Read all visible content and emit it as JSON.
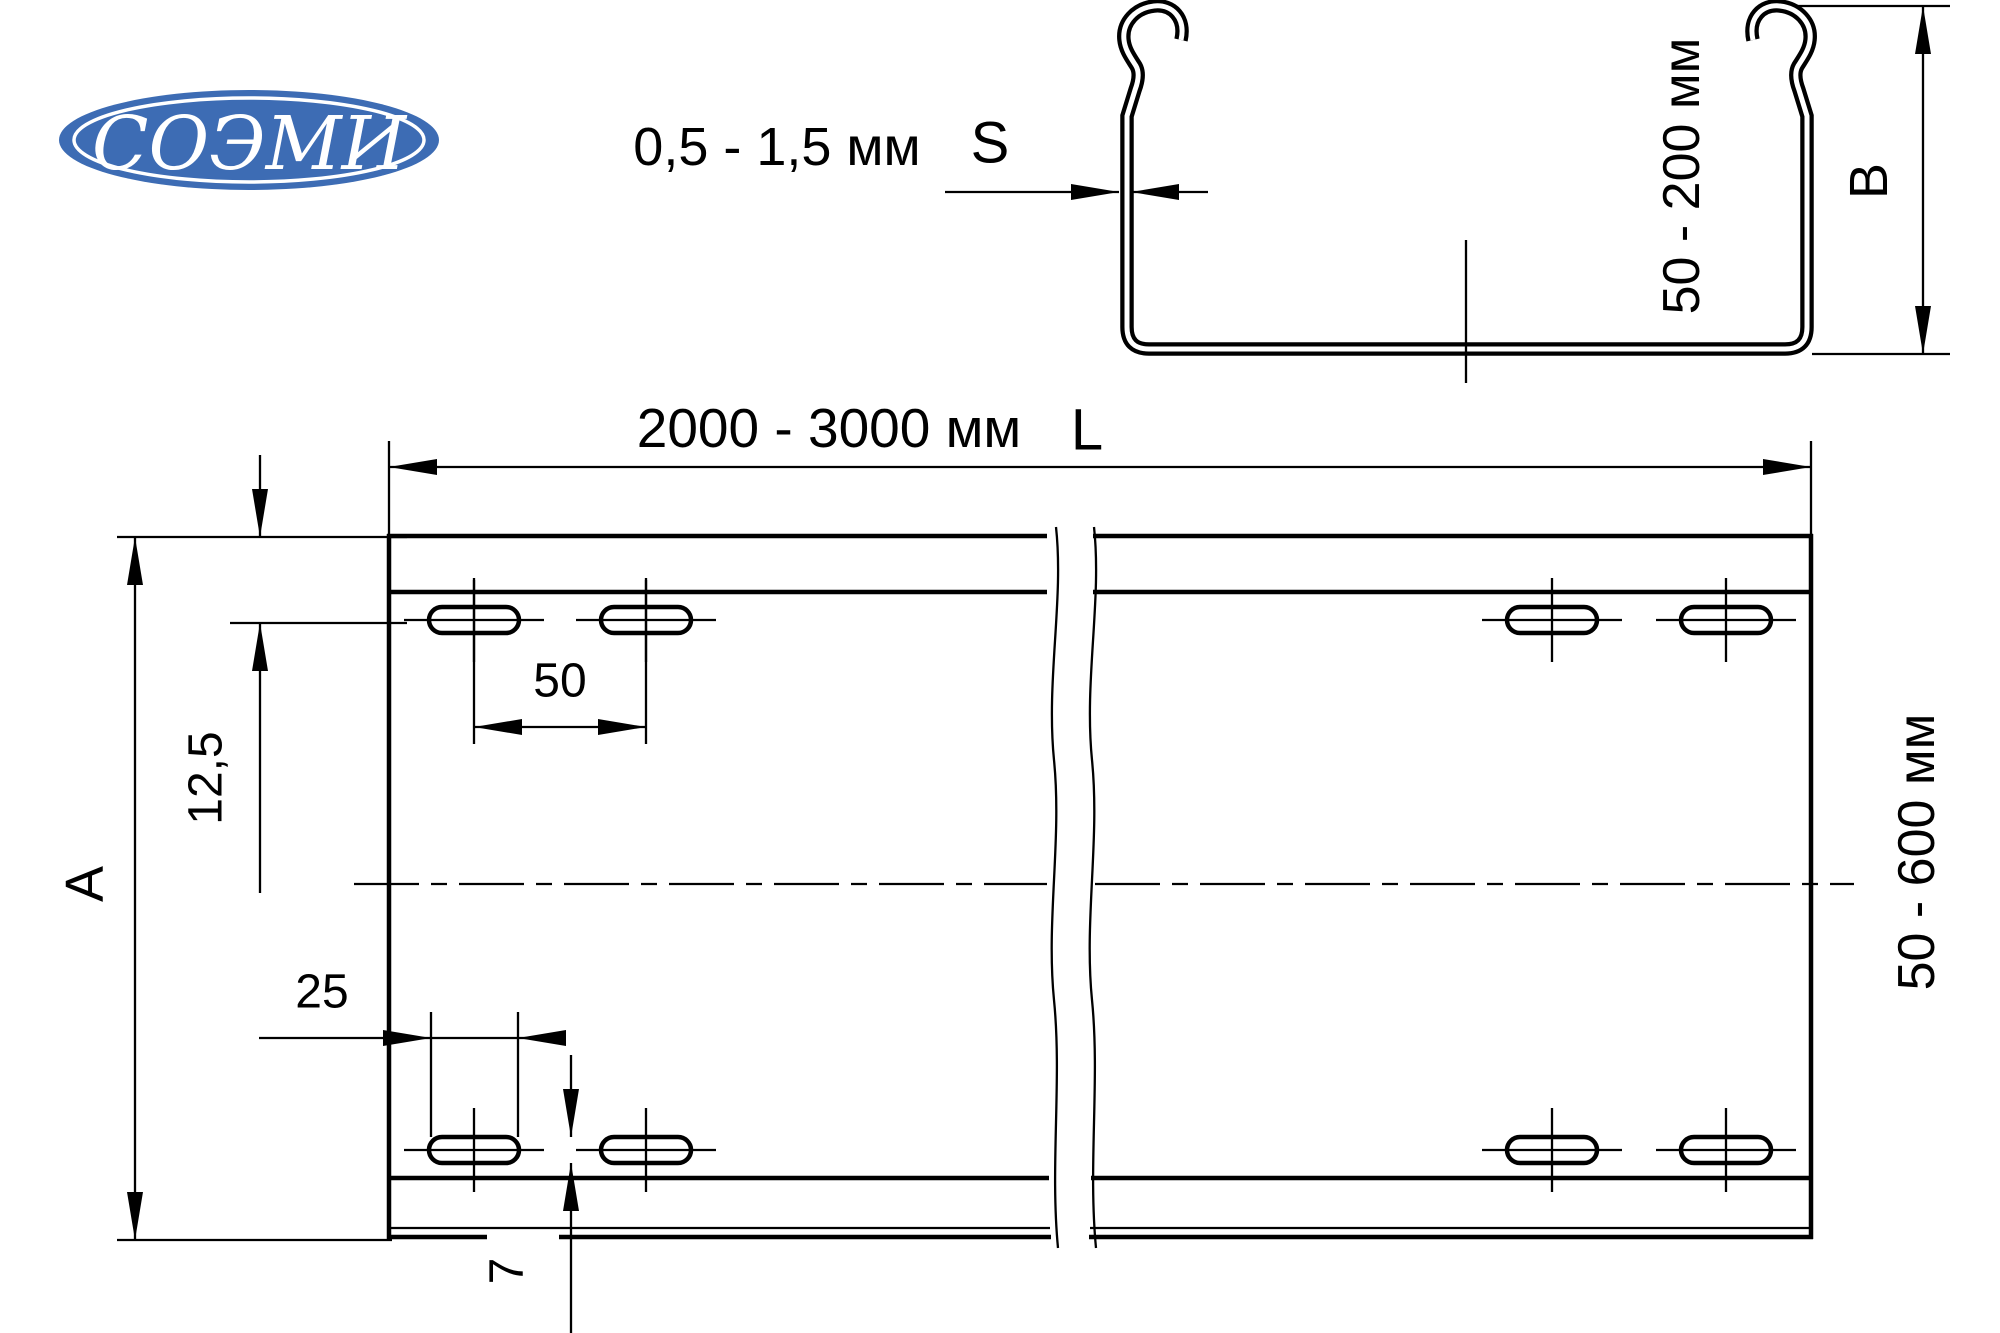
{
  "logo": {
    "text": "СОЭМИ"
  },
  "colors": {
    "logo_blue": "#3d6cb4",
    "line": "#000000",
    "background": "#ffffff"
  },
  "profile_view": {
    "thickness_label": "0,5 - 1,5 мм",
    "thickness_symbol": "S",
    "height_label": "50 - 200 мм",
    "height_symbol": "B"
  },
  "plan_view": {
    "length_label": "2000 - 3000 мм",
    "length_symbol": "L",
    "width_label": "50 - 600 мм",
    "width_symbol": "A",
    "hole_spacing_label": "50",
    "row_offset_label": "12,5",
    "slot_length_label": "25",
    "slot_width_label": "7"
  }
}
